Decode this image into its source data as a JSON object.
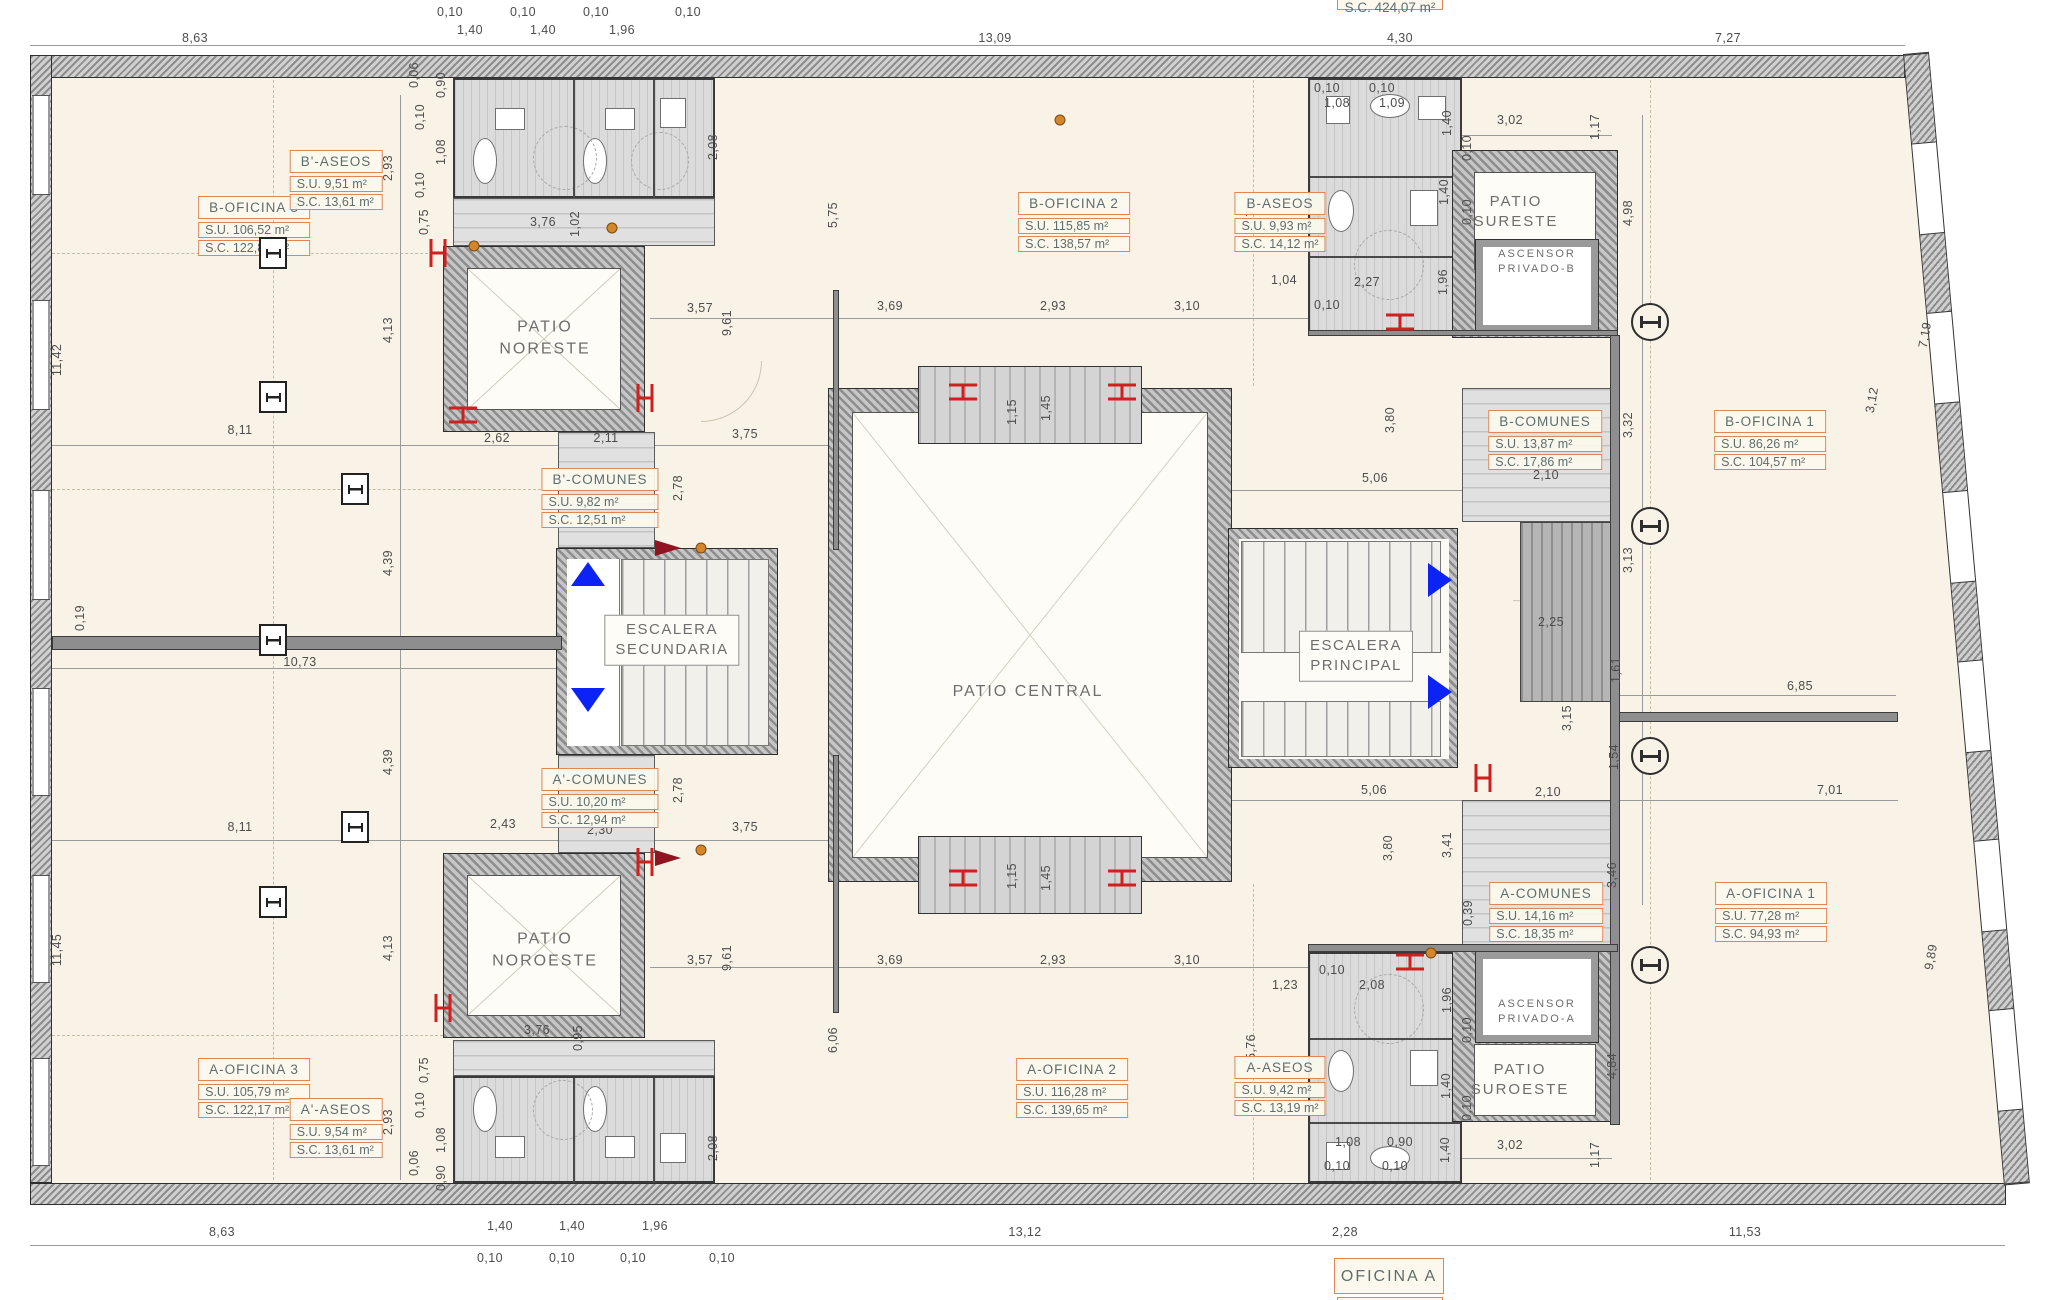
{
  "titles": {
    "top_area": "S.C. 424,07 m²",
    "bottom": "OFICINA A"
  },
  "colors": {
    "paper": "#f8f3e6",
    "accent_orange": "#df8659",
    "arrow_blue": "#0b24f5",
    "radiator_red": "#cf1f1f",
    "wall_gray": "#8d8d8d"
  },
  "area_boxes": [
    {
      "x": 254,
      "y": 196,
      "title": "B-OFICINA 3",
      "su": "S.U.  106,52 m²",
      "sc": "S.C.  122,82 m²"
    },
    {
      "x": 336,
      "y": 150,
      "title": "B'-ASEOS",
      "su": "S.U.  9,51 m²",
      "sc": "S.C.  13,61 m²"
    },
    {
      "x": 1074,
      "y": 192,
      "title": "B-OFICINA 2",
      "su": "S.U.  115,85 m²",
      "sc": "S.C.  138,57 m²"
    },
    {
      "x": 1280,
      "y": 192,
      "title": "B-ASEOS",
      "su": "S.U.  9,93 m²",
      "sc": "S.C.  14,12 m²"
    },
    {
      "x": 1545,
      "y": 410,
      "title": "B-COMUNES",
      "su": "S.U.  13,87 m²",
      "sc": "S.C.  17,86 m²"
    },
    {
      "x": 1770,
      "y": 410,
      "title": "B-OFICINA 1",
      "su": "S.U.  86,26 m²",
      "sc": "S.C.  104,57 m²"
    },
    {
      "x": 600,
      "y": 468,
      "title": "B'-COMUNES",
      "su": "S.U.  9,82 m²",
      "sc": "S.C.  12,51 m²"
    },
    {
      "x": 600,
      "y": 768,
      "title": "A'-COMUNES",
      "su": "S.U.  10,20 m²",
      "sc": "S.C.  12,94 m²"
    },
    {
      "x": 1546,
      "y": 882,
      "title": "A-COMUNES",
      "su": "S.U.  14,16 m²",
      "sc": "S.C.  18,35 m²"
    },
    {
      "x": 254,
      "y": 1058,
      "title": "A-OFICINA 3",
      "su": "S.U.  105,79 m²",
      "sc": "S.C.  122,17 m²"
    },
    {
      "x": 336,
      "y": 1098,
      "title": "A'-ASEOS",
      "su": "S.U.  9,54 m²",
      "sc": "S.C.  13,61 m²"
    },
    {
      "x": 1072,
      "y": 1058,
      "title": "A-OFICINA 2",
      "su": "S.U.  116,28 m²",
      "sc": "S.C.  139,65 m²"
    },
    {
      "x": 1280,
      "y": 1056,
      "title": "A-ASEOS",
      "su": "S.U.  9,42 m²",
      "sc": "S.C.  13,19 m²"
    },
    {
      "x": 1771,
      "y": 882,
      "title": "A-OFICINA 1",
      "su": "S.U.  77,28 m²",
      "sc": "S.C.  94,93 m²"
    }
  ],
  "space_labels": [
    {
      "x": 545,
      "y": 338,
      "s": 16,
      "lines": [
        "PATIO",
        "NORESTE"
      ]
    },
    {
      "x": 545,
      "y": 950,
      "s": 16,
      "lines": [
        "PATIO",
        "NOROESTE"
      ]
    },
    {
      "x": 1028,
      "y": 692,
      "s": 16,
      "lines": [
        "PATIO CENTRAL"
      ]
    },
    {
      "x": 1516,
      "y": 212,
      "s": 15,
      "lines": [
        "PATIO",
        "SURESTE"
      ]
    },
    {
      "x": 1537,
      "y": 262,
      "s": 11,
      "lines": [
        "ASCENSOR",
        "PRIVADO-B"
      ]
    },
    {
      "x": 1520,
      "y": 1080,
      "s": 15,
      "lines": [
        "PATIO",
        "SUROESTE"
      ]
    },
    {
      "x": 1537,
      "y": 1012,
      "s": 11,
      "lines": [
        "ASCENSOR",
        "PRIVADO-A"
      ]
    },
    {
      "x": 672,
      "y": 640,
      "s": 15,
      "box": 1,
      "lines": [
        "ESCALERA",
        "SECUNDARIA"
      ]
    },
    {
      "x": 1356,
      "y": 656,
      "s": 15,
      "box": 1,
      "lines": [
        "ESCALERA",
        "PRINCIPAL"
      ]
    }
  ],
  "dims": [
    {
      "t": "8,63",
      "x": 195,
      "y": 38
    },
    {
      "t": "0,10",
      "x": 450,
      "y": 12
    },
    {
      "t": "1,40",
      "x": 470,
      "y": 30
    },
    {
      "t": "0,10",
      "x": 523,
      "y": 12
    },
    {
      "t": "1,40",
      "x": 543,
      "y": 30
    },
    {
      "t": "0,10",
      "x": 596,
      "y": 12
    },
    {
      "t": "1,96",
      "x": 622,
      "y": 30
    },
    {
      "t": "0,10",
      "x": 688,
      "y": 12
    },
    {
      "t": "13,09",
      "x": 995,
      "y": 38
    },
    {
      "t": "4,30",
      "x": 1400,
      "y": 38
    },
    {
      "t": "7,27",
      "x": 1728,
      "y": 38
    },
    {
      "t": "0,06",
      "x": 414,
      "y": 75,
      "r": 1
    },
    {
      "t": "8,63",
      "x": 222,
      "y": 1232
    },
    {
      "t": "1,40",
      "x": 500,
      "y": 1226
    },
    {
      "t": "0,10",
      "x": 490,
      "y": 1258
    },
    {
      "t": "1,40",
      "x": 572,
      "y": 1226
    },
    {
      "t": "0,10",
      "x": 562,
      "y": 1258
    },
    {
      "t": "1,96",
      "x": 655,
      "y": 1226
    },
    {
      "t": "0,10",
      "x": 633,
      "y": 1258
    },
    {
      "t": "0,10",
      "x": 722,
      "y": 1258
    },
    {
      "t": "13,12",
      "x": 1025,
      "y": 1232
    },
    {
      "t": "2,28",
      "x": 1345,
      "y": 1232
    },
    {
      "t": "11,53",
      "x": 1745,
      "y": 1232
    },
    {
      "t": "11,42",
      "x": 57,
      "y": 360,
      "r": 1
    },
    {
      "t": "0,19",
      "x": 80,
      "y": 618,
      "r": 1
    },
    {
      "t": "11,45",
      "x": 57,
      "y": 950,
      "r": 1
    },
    {
      "t": "2,93",
      "x": 388,
      "y": 168,
      "r": 1
    },
    {
      "t": "4,13",
      "x": 388,
      "y": 330,
      "r": 1
    },
    {
      "t": "4,39",
      "x": 388,
      "y": 563,
      "r": 1
    },
    {
      "t": "4,39",
      "x": 388,
      "y": 762,
      "r": 1
    },
    {
      "t": "4,13",
      "x": 388,
      "y": 948,
      "r": 1
    },
    {
      "t": "2,93",
      "x": 388,
      "y": 1122,
      "r": 1
    },
    {
      "t": "0,90",
      "x": 441,
      "y": 85,
      "r": 1
    },
    {
      "t": "0,10",
      "x": 420,
      "y": 117,
      "r": 1
    },
    {
      "t": "1,08",
      "x": 441,
      "y": 152,
      "r": 1
    },
    {
      "t": "0,10",
      "x": 420,
      "y": 185,
      "r": 1
    },
    {
      "t": "0,75",
      "x": 424,
      "y": 222,
      "r": 1
    },
    {
      "t": "0,75",
      "x": 424,
      "y": 1070,
      "r": 1
    },
    {
      "t": "0,10",
      "x": 420,
      "y": 1105,
      "r": 1
    },
    {
      "t": "1,08",
      "x": 441,
      "y": 1140,
      "r": 1
    },
    {
      "t": "0,06",
      "x": 414,
      "y": 1163,
      "r": 1
    },
    {
      "t": "0,90",
      "x": 441,
      "y": 1178,
      "r": 1
    },
    {
      "t": "2,08",
      "x": 713,
      "y": 147,
      "r": 1
    },
    {
      "t": "2,08",
      "x": 713,
      "y": 1148,
      "r": 1
    },
    {
      "t": "3,76",
      "x": 543,
      "y": 222
    },
    {
      "t": "1,02",
      "x": 575,
      "y": 224,
      "r": 1
    },
    {
      "t": "3,76",
      "x": 537,
      "y": 1030
    },
    {
      "t": "0,95",
      "x": 578,
      "y": 1038,
      "r": 1
    },
    {
      "t": "8,11",
      "x": 240,
      "y": 430
    },
    {
      "t": "2,62",
      "x": 497,
      "y": 438
    },
    {
      "t": "2,11",
      "x": 606,
      "y": 438
    },
    {
      "t": "3,75",
      "x": 745,
      "y": 434
    },
    {
      "t": "10,73",
      "x": 300,
      "y": 662
    },
    {
      "t": "8,11",
      "x": 240,
      "y": 827
    },
    {
      "t": "2,43",
      "x": 503,
      "y": 824
    },
    {
      "t": "2,30",
      "x": 600,
      "y": 830
    },
    {
      "t": "3,75",
      "x": 745,
      "y": 827
    },
    {
      "t": "2,78",
      "x": 678,
      "y": 488,
      "r": 1
    },
    {
      "t": "2,78",
      "x": 678,
      "y": 790,
      "r": 1
    },
    {
      "t": "9,61",
      "x": 727,
      "y": 323,
      "r": 1
    },
    {
      "t": "9,61",
      "x": 727,
      "y": 958,
      "r": 1
    },
    {
      "t": "3,57",
      "x": 700,
      "y": 308
    },
    {
      "t": "3,69",
      "x": 890,
      "y": 306
    },
    {
      "t": "2,93",
      "x": 1053,
      "y": 306
    },
    {
      "t": "3,10",
      "x": 1187,
      "y": 306
    },
    {
      "t": "3,57",
      "x": 700,
      "y": 960
    },
    {
      "t": "3,69",
      "x": 890,
      "y": 960
    },
    {
      "t": "2,93",
      "x": 1053,
      "y": 960
    },
    {
      "t": "3,10",
      "x": 1187,
      "y": 960
    },
    {
      "t": "5,75",
      "x": 833,
      "y": 215,
      "r": 1
    },
    {
      "t": "5,76",
      "x": 1251,
      "y": 215,
      "r": 1
    },
    {
      "t": "6,06",
      "x": 833,
      "y": 1040,
      "r": 1
    },
    {
      "t": "5,76",
      "x": 1251,
      "y": 1047,
      "r": 1
    },
    {
      "t": "1,15",
      "x": 1012,
      "y": 412,
      "r": 1
    },
    {
      "t": "1,45",
      "x": 1046,
      "y": 408,
      "r": 1
    },
    {
      "t": "1,15",
      "x": 1012,
      "y": 876,
      "r": 1
    },
    {
      "t": "1,45",
      "x": 1046,
      "y": 878,
      "r": 1
    },
    {
      "t": "0,10",
      "x": 1327,
      "y": 88
    },
    {
      "t": "1,08",
      "x": 1337,
      "y": 103
    },
    {
      "t": "0,10",
      "x": 1382,
      "y": 88
    },
    {
      "t": "1,09",
      "x": 1392,
      "y": 103
    },
    {
      "t": "3,02",
      "x": 1510,
      "y": 120
    },
    {
      "t": "1,17",
      "x": 1595,
      "y": 127,
      "r": 1
    },
    {
      "t": "1,40",
      "x": 1447,
      "y": 123,
      "r": 1
    },
    {
      "t": "0,10",
      "x": 1467,
      "y": 148,
      "r": 1
    },
    {
      "t": "1,40",
      "x": 1444,
      "y": 192,
      "r": 1
    },
    {
      "t": "0,10",
      "x": 1467,
      "y": 212,
      "r": 1
    },
    {
      "t": "1,96",
      "x": 1443,
      "y": 282,
      "r": 1
    },
    {
      "t": "2,27",
      "x": 1367,
      "y": 282
    },
    {
      "t": "1,04",
      "x": 1284,
      "y": 280
    },
    {
      "t": "0,10",
      "x": 1327,
      "y": 305
    },
    {
      "t": "4,98",
      "x": 1628,
      "y": 213,
      "r": 1
    },
    {
      "t": "3,32",
      "x": 1628,
      "y": 425,
      "r": 1
    },
    {
      "t": "2,10",
      "x": 1546,
      "y": 475
    },
    {
      "t": "5,06",
      "x": 1375,
      "y": 478
    },
    {
      "t": "3,80",
      "x": 1390,
      "y": 420,
      "r": 1
    },
    {
      "t": "3,13",
      "x": 1628,
      "y": 560,
      "r": 1
    },
    {
      "t": "2,25",
      "x": 1551,
      "y": 622
    },
    {
      "t": "3,15",
      "x": 1567,
      "y": 718,
      "r": 1
    },
    {
      "t": "1,61",
      "x": 1616,
      "y": 670,
      "r": 1
    },
    {
      "t": "1,54",
      "x": 1614,
      "y": 757,
      "r": 1
    },
    {
      "t": "2,10",
      "x": 1548,
      "y": 792
    },
    {
      "t": "5,06",
      "x": 1374,
      "y": 790
    },
    {
      "t": "3,80",
      "x": 1388,
      "y": 848,
      "r": 1
    },
    {
      "t": "3,41",
      "x": 1447,
      "y": 845,
      "r": 1
    },
    {
      "t": "3,46",
      "x": 1612,
      "y": 875,
      "r": 1
    },
    {
      "t": "0,39",
      "x": 1468,
      "y": 913,
      "r": 1
    },
    {
      "t": "6,85",
      "x": 1800,
      "y": 686
    },
    {
      "t": "7,01",
      "x": 1830,
      "y": 790
    },
    {
      "t": "9,89",
      "x": 1931,
      "y": 957,
      "r": 2
    },
    {
      "t": "7,19",
      "x": 1925,
      "y": 335,
      "r": 2
    },
    {
      "t": "3,12",
      "x": 1872,
      "y": 400,
      "r": 2
    },
    {
      "t": "1,23",
      "x": 1285,
      "y": 985
    },
    {
      "t": "0,10",
      "x": 1332,
      "y": 970
    },
    {
      "t": "2,08",
      "x": 1372,
      "y": 985
    },
    {
      "t": "1,96",
      "x": 1447,
      "y": 1000,
      "r": 1
    },
    {
      "t": "0,10",
      "x": 1467,
      "y": 1030,
      "r": 1
    },
    {
      "t": "1,40",
      "x": 1446,
      "y": 1086,
      "r": 1
    },
    {
      "t": "0,10",
      "x": 1467,
      "y": 1108,
      "r": 1
    },
    {
      "t": "4,84",
      "x": 1612,
      "y": 1066,
      "r": 1
    },
    {
      "t": "3,02",
      "x": 1510,
      "y": 1145
    },
    {
      "t": "1,17",
      "x": 1595,
      "y": 1155,
      "r": 1
    },
    {
      "t": "1,08",
      "x": 1348,
      "y": 1142
    },
    {
      "t": "0,90",
      "x": 1400,
      "y": 1142
    },
    {
      "t": "0,10",
      "x": 1337,
      "y": 1166
    },
    {
      "t": "0,10",
      "x": 1395,
      "y": 1166
    },
    {
      "t": "1,40",
      "x": 1445,
      "y": 1150,
      "r": 1
    }
  ],
  "symbols": {
    "grid_circles": [
      [
        1650,
        322
      ],
      [
        1650,
        526
      ],
      [
        1650,
        756
      ],
      [
        1650,
        965
      ]
    ],
    "square_columns": [
      [
        273,
        253
      ],
      [
        273,
        397
      ],
      [
        355,
        489
      ],
      [
        273,
        640
      ],
      [
        355,
        827
      ],
      [
        273,
        902
      ]
    ],
    "radiators": [
      {
        "x": 438,
        "y": 253,
        "v": 1
      },
      {
        "x": 463,
        "y": 415,
        "v": 0
      },
      {
        "x": 645,
        "y": 398,
        "v": 1
      },
      {
        "x": 963,
        "y": 392,
        "v": 0
      },
      {
        "x": 1122,
        "y": 392,
        "v": 0
      },
      {
        "x": 963,
        "y": 878,
        "v": 0
      },
      {
        "x": 1122,
        "y": 878,
        "v": 0
      },
      {
        "x": 1400,
        "y": 322,
        "v": 0
      },
      {
        "x": 1410,
        "y": 962,
        "v": 0
      },
      {
        "x": 1483,
        "y": 778,
        "v": 1
      },
      {
        "x": 443,
        "y": 1008,
        "v": 1
      },
      {
        "x": 645,
        "y": 862,
        "v": 1
      }
    ],
    "blue_arrows": [
      {
        "x": 588,
        "y": 574,
        "d": "up"
      },
      {
        "x": 588,
        "y": 700,
        "d": "down"
      },
      {
        "x": 1440,
        "y": 580,
        "d": "right"
      },
      {
        "x": 1440,
        "y": 692,
        "d": "right"
      }
    ],
    "orange_dots": [
      [
        474,
        246
      ],
      [
        701,
        548
      ],
      [
        701,
        850
      ],
      [
        1431,
        953
      ],
      [
        1060,
        120
      ],
      [
        612,
        228
      ]
    ],
    "dark_wedges": [
      [
        668,
        548
      ],
      [
        668,
        858
      ]
    ]
  }
}
